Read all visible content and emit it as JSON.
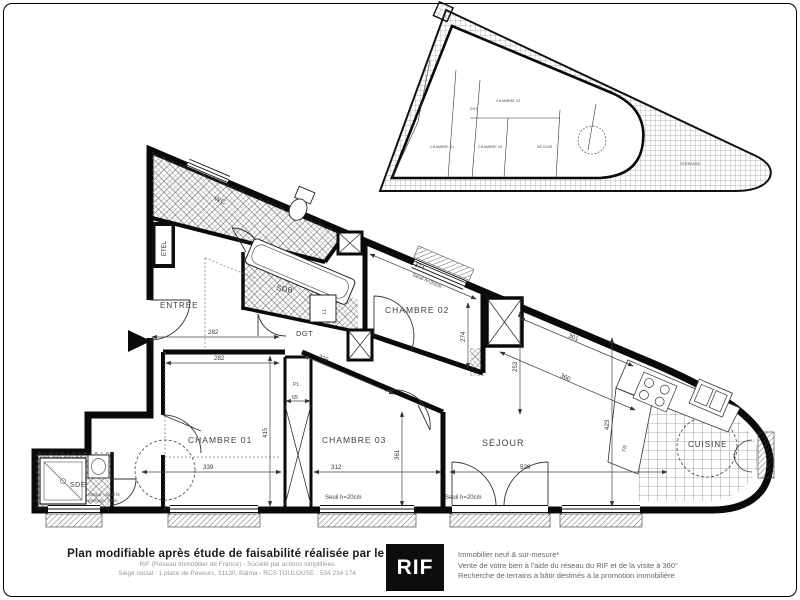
{
  "footer": {
    "left_title": "Plan modifiable après étude de faisabilité réalisée par le RIF",
    "left_line2": "RIF (Réseau Immobilier de France) - Société par actions simplifiées",
    "left_line3": "Siège social : 1 place de Paveurs, 31130, Balma - RCS TOULOUSE : 534 234 174",
    "logo_text": "RIF",
    "right_line1": "Immobilier neuf & sur-mesure*",
    "right_line2": "Vente de votre bien à l'aide du réseau du RIF et de la visite à 360°",
    "right_line3": "Recherche de terrains à bâtir destinés à la promotion immobilière"
  },
  "plan": {
    "rooms": {
      "entree": "ENTRÉE",
      "wc": "WC",
      "sdb": "SDB",
      "dgt": "DGT",
      "chambre02": "CHAMBRE 02",
      "chambre01": "CHAMBRE 01",
      "chambre03": "CHAMBRE 03",
      "sejour": "SÉJOUR",
      "cuisine": "CUISINE",
      "sde": "SDE",
      "placard": "PL",
      "lave_linge": "LL",
      "frigo": "FR",
      "etel": "ETEL"
    },
    "dimensions": {
      "chambre02_width": "374",
      "chambre02_depth": "274",
      "entree_width": "282",
      "chambre01_width": "282",
      "chambre01_depth": "415",
      "chambre01_window": "339",
      "chambre03_width": "312",
      "chambre03_depth": "361",
      "dgt_diag": "226",
      "placard_width": "65",
      "sejour_top": "301",
      "sejour_diag": "360",
      "sejour_depth": "423",
      "sejour_left": "253",
      "sejour_width": "529"
    },
    "annotations": {
      "seuil": "Seuil h=20cm",
      "sde_note1": "Vasque - Seuil ht",
      "sde_note2": "passage : 20cm"
    }
  },
  "inset": {
    "labels": {
      "chambre02": "CHAMBRE 02",
      "dgt": "DGT",
      "chambre01": "CHAMBRE 01",
      "chambre03": "CHAMBRE 03",
      "sejour": "SÉJOUR",
      "terrasse": "TERRASSE"
    }
  }
}
